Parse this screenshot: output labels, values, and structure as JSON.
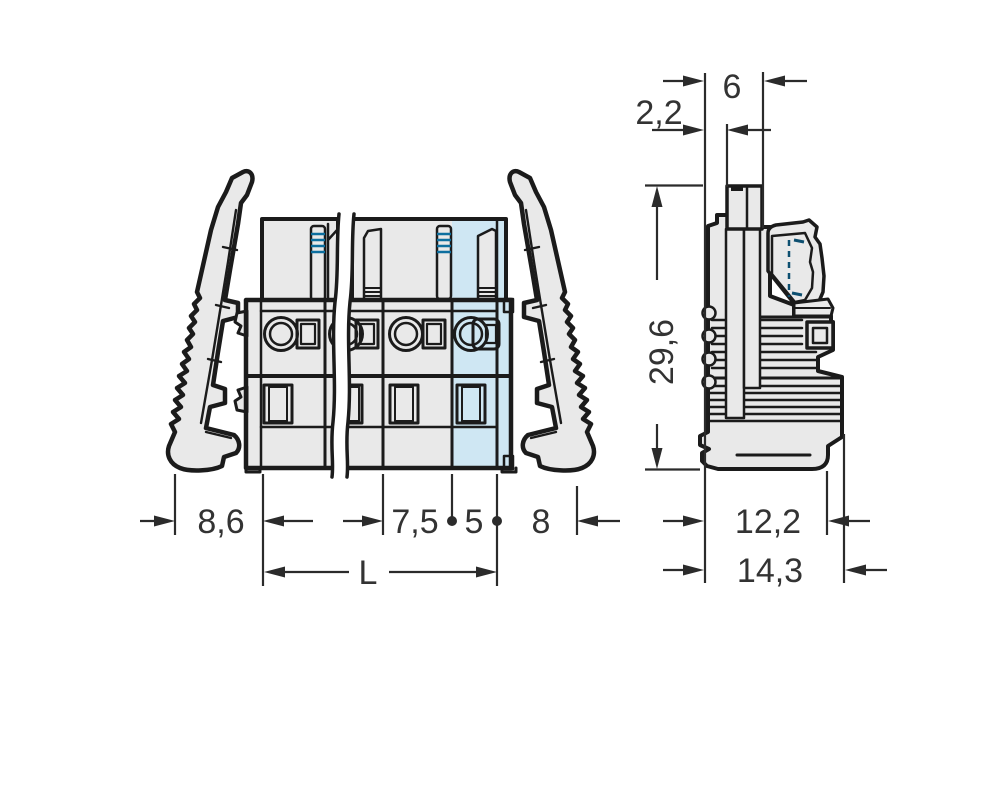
{
  "drawing": {
    "view_front": "multi-pole-connector-front-view",
    "view_side": "connector-side-view",
    "dimensions": {
      "top_offset": "2,2",
      "pin_width": "6",
      "height": "29,6",
      "left_latch": "8,6",
      "pitch": "7,5",
      "pole_width": "5",
      "right_latch": "8",
      "length": "L",
      "depth_inner": "12,2",
      "depth_total": "14,3"
    },
    "colors": {
      "lever_blue": "#1e9cd8",
      "lever_blue_rib": "#0d6f9f",
      "highlight_blue": "#cfe7f3",
      "marker_yellow": "#ffdf00",
      "marker_gold": "#c8ad36",
      "housing_grey": "#e9e9e9",
      "outline": "#1b1b1b"
    }
  }
}
